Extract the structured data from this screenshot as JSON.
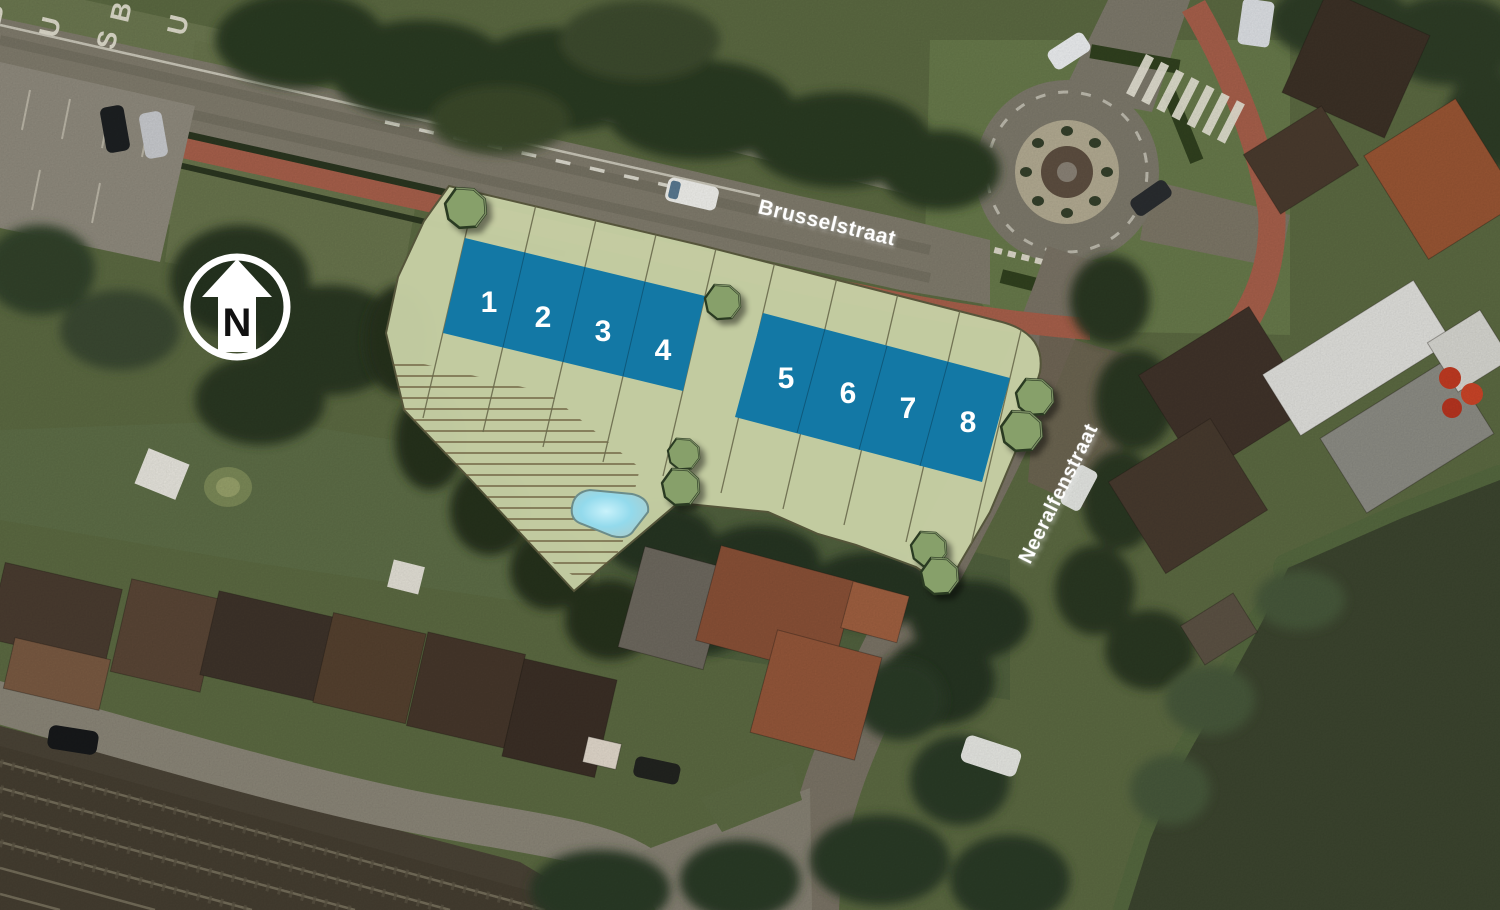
{
  "north_arrow": {
    "label": "N"
  },
  "road_marking": {
    "text": "BUS",
    "letters": [
      "B",
      "U",
      "S"
    ]
  },
  "streets": [
    {
      "name": "Brusselstraat"
    },
    {
      "name": "Neeralfenstraat"
    }
  ],
  "site": {
    "lots": [
      {
        "number": "1"
      },
      {
        "number": "2"
      },
      {
        "number": "3"
      },
      {
        "number": "4"
      },
      {
        "number": "5"
      },
      {
        "number": "6"
      },
      {
        "number": "7"
      },
      {
        "number": "8"
      }
    ]
  },
  "colors": {
    "site_overlay": "#c6cfa4",
    "site_outline": "#55553a",
    "lot_fill": "#1378a5",
    "lot_number": "#ffffff",
    "tree_fill": "#87a06b",
    "tree_outline": "#2c3a22",
    "pond_edge": "#a9d2d2",
    "hatch": "#6a5c3c",
    "road": "#817c6d",
    "cycle_path": "#a8604b",
    "street_label": "#ffffff",
    "grass": "#5c6a42",
    "forest": "#2c3a24",
    "water": "#3c452f",
    "railway": "#453e31"
  }
}
